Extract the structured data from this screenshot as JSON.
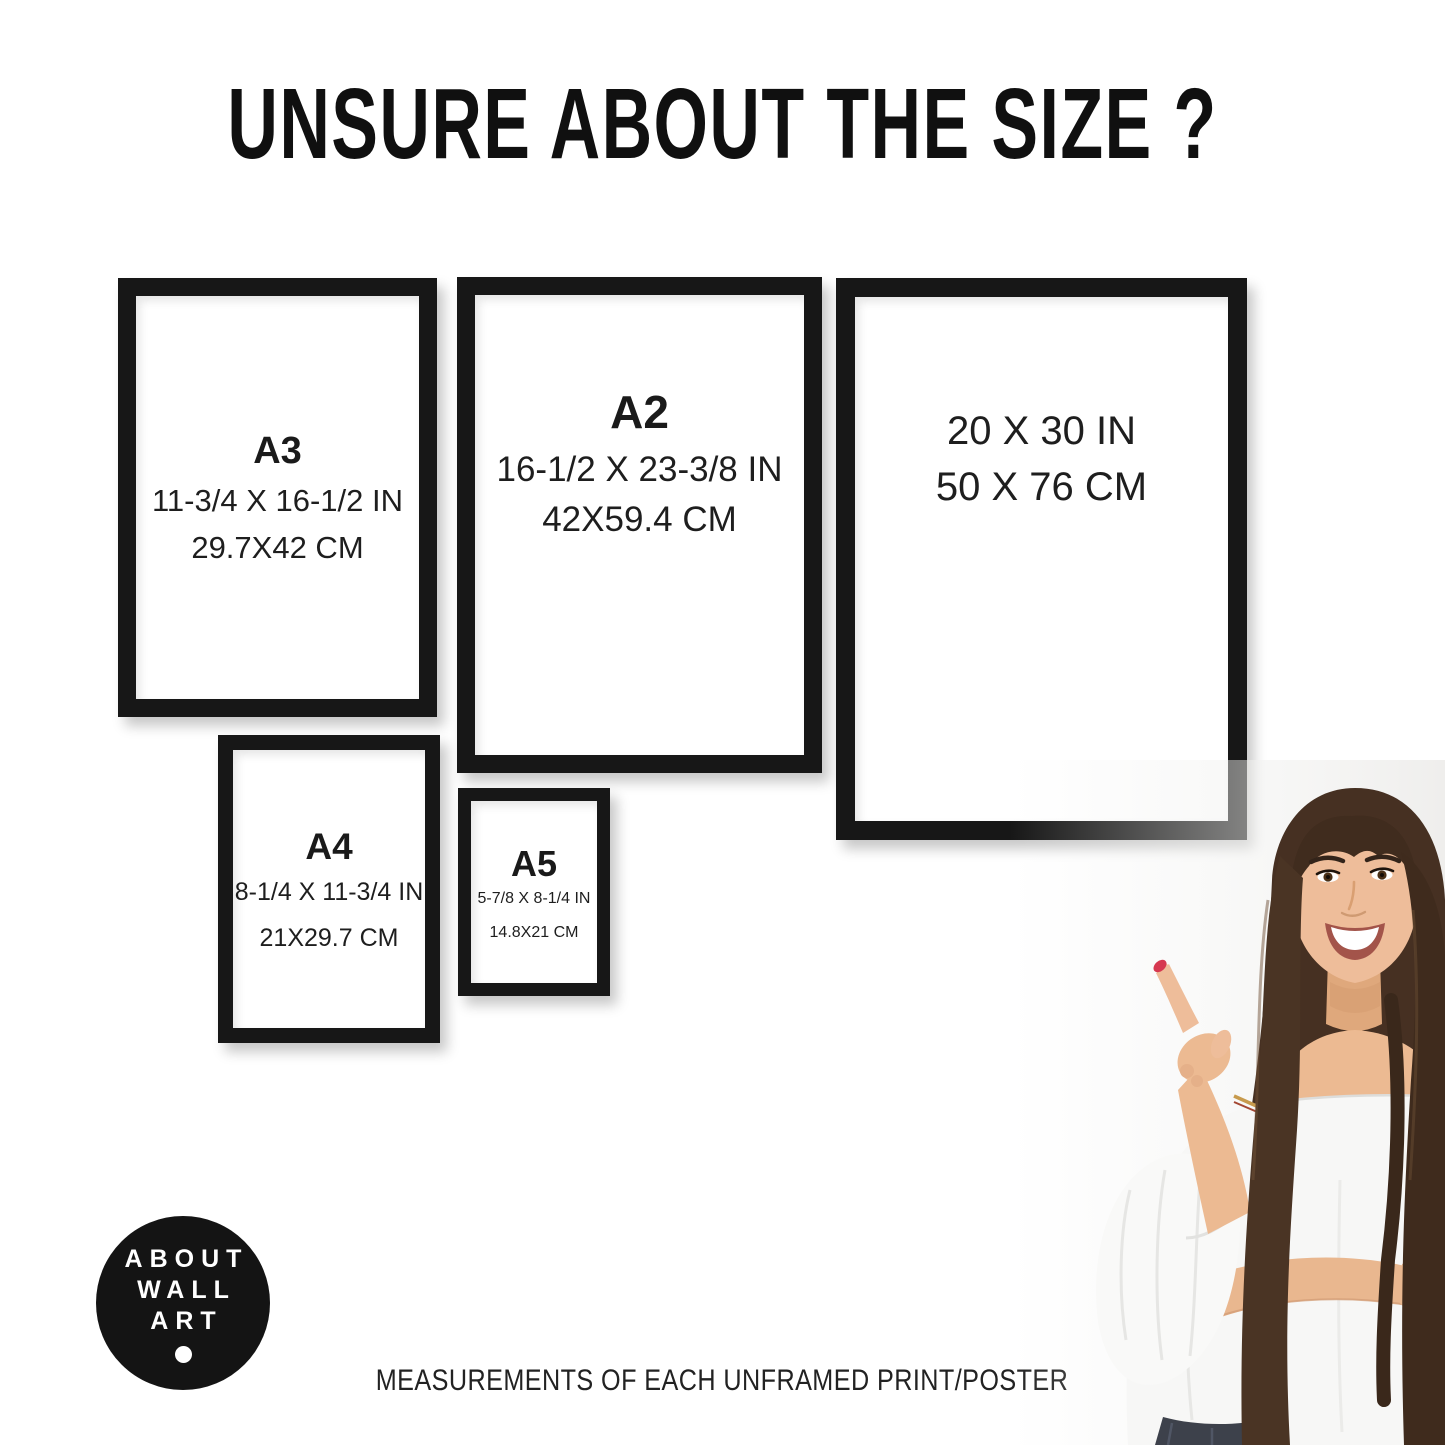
{
  "title": "UNSURE ABOUT THE SIZE ?",
  "frames": [
    {
      "name": "A3",
      "inches": "11-3/4 X 16-1/2 IN",
      "cm": "29.7X42 CM"
    },
    {
      "name": "A2",
      "inches": "16-1/2 X 23-3/8 IN",
      "cm": "42X59.4 CM"
    },
    {
      "name": null,
      "inches": "20 X 30 IN",
      "cm": "50 X 76 CM"
    },
    {
      "name": "A4",
      "inches": "8-1/4 X 11-3/4 IN",
      "cm": "21X29.7 CM"
    },
    {
      "name": "A5",
      "inches": "5-7/8 X 8-1/4 IN",
      "cm": "14.8X21 CM"
    }
  ],
  "logo": {
    "lines": [
      "ABOUT",
      "WALL",
      "ART"
    ]
  },
  "footer": "MEASUREMENTS OF EACH UNFRAMED PRINT/POSTER",
  "colors": {
    "frame_black": "#171717",
    "text_black": "#1e1e1e",
    "logo_background": "#141414",
    "logo_text": "#ffffff",
    "nail_red": "#d63850",
    "hair_brown": "#463022",
    "skin_tone": "#ecba92",
    "blouse_white": "#f7f7f6",
    "jeans_dark": "#3d414b"
  }
}
